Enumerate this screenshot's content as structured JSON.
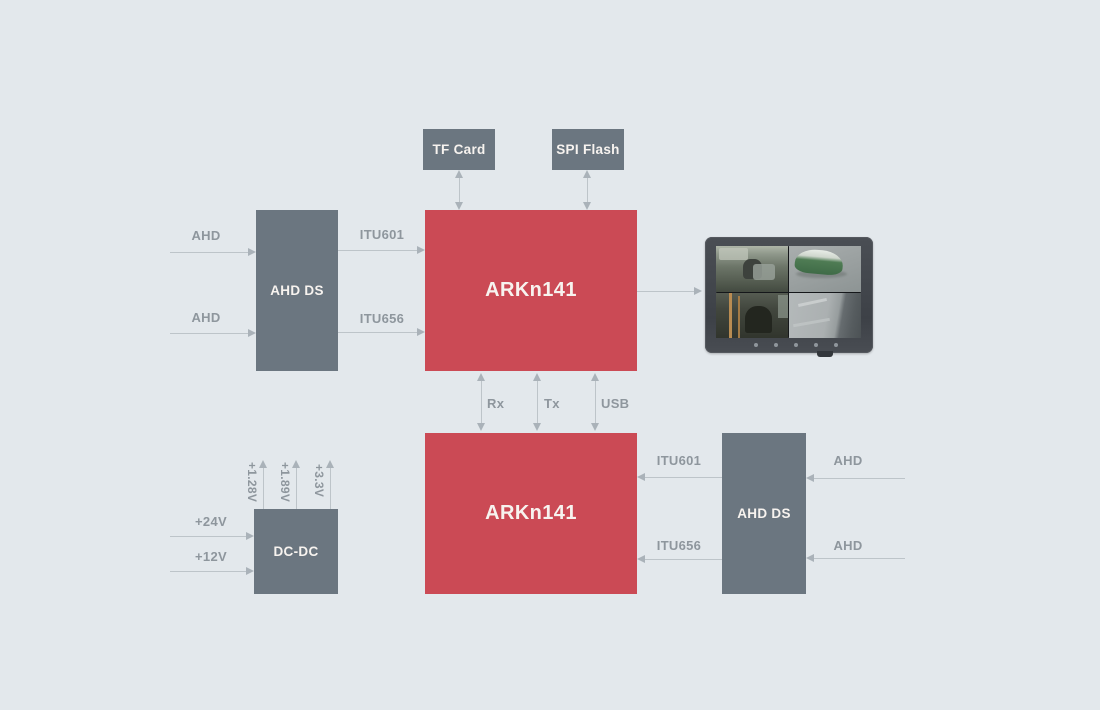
{
  "palette": {
    "background": "#e3e8ec",
    "block_gray": "#6b7680",
    "block_red": "#cb4a55",
    "block_text": "#f7f3ef",
    "connector_line": "#bdc4c9",
    "connector_label": "#8e969d",
    "monitor_bezel": "#42464c"
  },
  "blocks": {
    "tf_card": {
      "label": "TF Card"
    },
    "spi_flash": {
      "label": "SPI Flash"
    },
    "soc_top": {
      "label": "ARKn141"
    },
    "soc_bottom": {
      "label": "ARKn141"
    },
    "ahd_ds_left": {
      "label": "AHD DS"
    },
    "ahd_ds_right": {
      "label": "AHD DS"
    },
    "dc_dc": {
      "label": "DC-DC"
    }
  },
  "labels": {
    "ahd_in_top_1": "AHD",
    "ahd_in_top_2": "AHD",
    "itu601_top": "ITU601",
    "itu656_top": "ITU656",
    "rx": "Rx",
    "tx": "Tx",
    "usb": "USB",
    "itu601_bottom": "ITU601",
    "itu656_bottom": "ITU656",
    "ahd_in_right_1": "AHD",
    "ahd_in_right_2": "AHD",
    "v24": "+24V",
    "v12": "+12V",
    "v1_28": "+1.28V",
    "v1_89": "+1.89V",
    "v3_3": "+3.3V"
  },
  "monitor": {
    "semantic": "quad-camera-view-display",
    "views": [
      "bus interior front",
      "bus exterior top view",
      "bus interior seats",
      "road surface"
    ],
    "button_count": 5
  }
}
